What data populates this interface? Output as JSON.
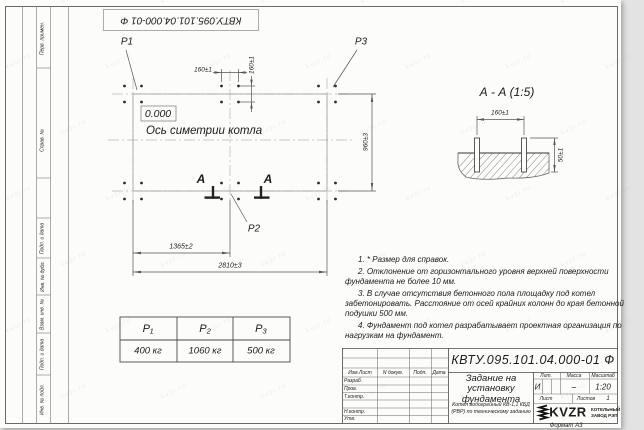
{
  "stamp_top": "КВТУ.095.101.04.000-01 Ф",
  "watermark": "kvzr.ru",
  "side_labels": [
    "Перв. примен.",
    "Справ. №",
    "Подп. и дата",
    "Инв. № дубл.",
    "Взам. инв. №",
    "Подп. и дата",
    "Инв. № подл."
  ],
  "plan": {
    "p1": "P1",
    "p2": "P2",
    "p3": "P3",
    "elevation": "0.000",
    "axis_label": "Ось симетрии котла",
    "section_letter": "А",
    "dims": {
      "d160h": "160±1",
      "d160v": "160±1",
      "d960": "960±3",
      "d1365": "1365±2",
      "d2810": "2810±3"
    }
  },
  "section_view": {
    "title": "А - А (1:5)",
    "dim160": "160±1",
    "dim50": "50±1"
  },
  "load_table": {
    "headers": [
      "P₁",
      "P₂",
      "P₃"
    ],
    "values": [
      "400 кг",
      "1060 кг",
      "500 кг"
    ]
  },
  "notes": [
    "1. * Размер для справок.",
    "2. Отклонение от горизонтального уровня верхней поверхности фундамента не более 10 мм.",
    "3. В случае отсутствия бетонного пола площадку под котел забетонировать. Расстояние от осей крайних колонн до края бетонной подушки 500 мм.",
    "4. Фундамент под котел разрабатывает проектная организация по нагрузкам на фундамент."
  ],
  "title_block": {
    "doc_number": "КВТУ.095.101.04.000-01 Ф",
    "title": "Задание на установку фундамента",
    "subtitle": "Котел водогрейный КВ-1,1 КБД (РВР) по техническому заданию",
    "rev_headers": [
      "Изм.Лист",
      "N докум.",
      "Подп.",
      "Дата"
    ],
    "row_labels": [
      "Разраб.",
      "Пров.",
      "Т.контр.",
      "Н.контр.",
      "Утв."
    ],
    "lit_header": "Лит.",
    "lit_value": "И",
    "mass_header": "Масса",
    "mass_value": "–",
    "scale_header": "Масштаб",
    "scale_value": "1:20",
    "sheet_label": "Лист",
    "sheets_label": "Листов",
    "sheets_value": "1",
    "logo_text": "KVZR",
    "logo_caption1": "КОТЕЛЬНЫЙ",
    "logo_caption2": "ЗАВОД РЭП",
    "format_label": "Формат А3"
  }
}
